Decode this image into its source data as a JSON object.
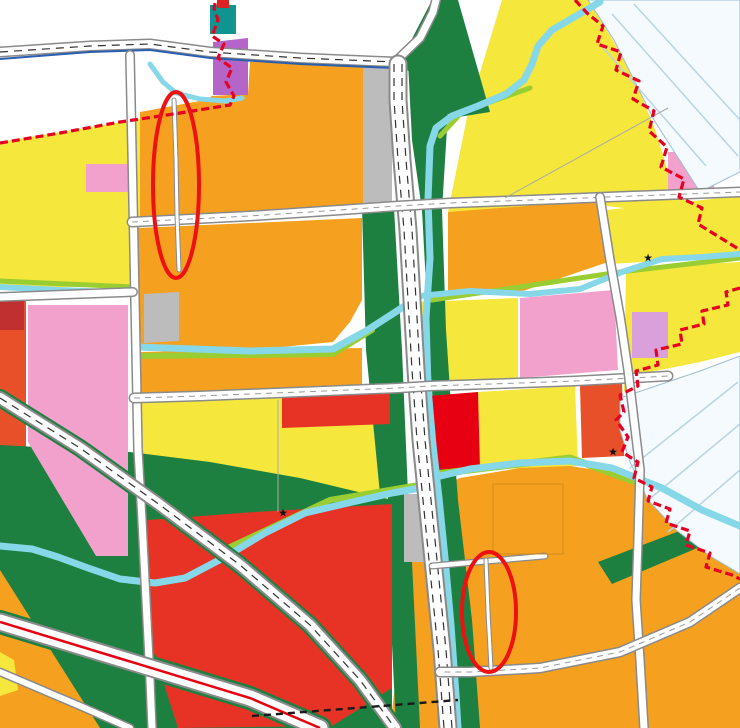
{
  "map": {
    "palette": {
      "yellow": "#F5E73B",
      "orange": "#F5A01E",
      "orange_red": "#E8502A",
      "red": "#E63326",
      "bright_red": "#E60012",
      "pink": "#F2A0CC",
      "violet": "#B565C8",
      "purple": "#7B3FA0",
      "gray": "#BCBCBC",
      "green": "#1E8040",
      "lime": "#9ACD32",
      "river": "#86D7E8",
      "teal": "#0F9490",
      "boundary_red": "#E60023",
      "annotation_red": "#EE1111"
    },
    "road_labels": [
      {
        "text": "青",
        "x": 56,
        "y": 45
      },
      {
        "text": "路",
        "x": 310,
        "y": 83
      },
      {
        "text": "路",
        "x": 406,
        "y": 25
      },
      {
        "text": "胜",
        "x": 218,
        "y": 225
      },
      {
        "text": "巷",
        "x": 343,
        "y": 211
      },
      {
        "text": "路",
        "x": 558,
        "y": 201
      },
      {
        "text": "海",
        "x": 414,
        "y": 167
      },
      {
        "text": "曹",
        "x": 131,
        "y": 153
      },
      {
        "text": "浦",
        "x": 135,
        "y": 379
      },
      {
        "text": "路",
        "x": 141,
        "y": 577
      },
      {
        "text": "路",
        "x": 83,
        "y": 301
      },
      {
        "text": "泗",
        "x": 201,
        "y": 395
      },
      {
        "text": "泾",
        "x": 428,
        "y": 387
      },
      {
        "text": "路",
        "x": 576,
        "y": 381
      },
      {
        "text": "曹",
        "x": 621,
        "y": 315
      },
      {
        "text": "新",
        "x": 638,
        "y": 541
      },
      {
        "text": "绕",
        "x": 401,
        "y": 463
      },
      {
        "text": "国",
        "x": 314,
        "y": 629
      },
      {
        "text": "高",
        "x": 152,
        "y": 693
      },
      {
        "text": "新",
        "x": 689,
        "y": 619
      }
    ],
    "river_labels": [
      {
        "text": "泾",
        "x": 29,
        "y": 141
      },
      {
        "text": "河",
        "x": 169,
        "y": 111
      },
      {
        "text": "沈",
        "x": 546,
        "y": 31
      },
      {
        "text": "巷",
        "x": 501,
        "y": 95
      },
      {
        "text": "新",
        "x": 444,
        "y": 126
      },
      {
        "text": "开",
        "x": 431,
        "y": 239
      },
      {
        "text": "河",
        "x": 424,
        "y": 335
      },
      {
        "text": "鞋",
        "x": 289,
        "y": 338
      },
      {
        "text": "城",
        "x": 499,
        "y": 294
      },
      {
        "text": "浜",
        "x": 667,
        "y": 250
      },
      {
        "text": "河",
        "x": 693,
        "y": 129
      },
      {
        "text": "河",
        "x": 723,
        "y": 429
      },
      {
        "text": "浜",
        "x": 49,
        "y": 285
      },
      {
        "text": "河",
        "x": 66,
        "y": 554
      },
      {
        "text": "泗",
        "x": 329,
        "y": 503
      },
      {
        "text": "泾",
        "x": 517,
        "y": 468
      }
    ],
    "parcel_codes": [
      {
        "text": "1503",
        "x": 222,
        "y": 20,
        "variant": "light"
      },
      {
        "text": "0901",
        "x": 222,
        "y": 84
      },
      {
        "text": "070102",
        "x": 509,
        "y": 25
      },
      {
        "text": "070102",
        "x": 579,
        "y": 98
      },
      {
        "text": "1401",
        "x": 533,
        "y": 70,
        "variant": "blue"
      },
      {
        "text": "070102",
        "x": 635,
        "y": 152
      },
      {
        "text": "080404",
        "x": 689,
        "y": 181
      },
      {
        "text": "0709",
        "x": 272,
        "y": 141
      },
      {
        "text": "120603",
        "x": 375,
        "y": 137
      },
      {
        "text": "0709",
        "x": 152,
        "y": 168
      },
      {
        "text": "080404",
        "x": 106,
        "y": 185
      },
      {
        "text": "0709",
        "x": 154,
        "y": 256
      },
      {
        "text": "0709",
        "x": 279,
        "y": 281
      },
      {
        "text": "0709",
        "x": 509,
        "y": 254
      },
      {
        "text": "070102",
        "x": 671,
        "y": 226
      },
      {
        "text": "0901",
        "x": 638,
        "y": 242
      },
      {
        "text": "070102",
        "x": 691,
        "y": 291
      },
      {
        "text": "0901",
        "x": 647,
        "y": 331
      },
      {
        "text": "080404",
        "x": 648,
        "y": 345
      },
      {
        "text": "080403",
        "x": 569,
        "y": 343
      },
      {
        "text": "080403",
        "x": 73,
        "y": 391
      },
      {
        "text": "080401",
        "x": 22,
        "y": 338
      },
      {
        "text": "0709",
        "x": 159,
        "y": 304
      },
      {
        "text": "120603",
        "x": 161,
        "y": 336
      },
      {
        "text": "0706",
        "x": 244,
        "y": 373
      },
      {
        "text": "070102",
        "x": 214,
        "y": 463
      },
      {
        "text": "070102",
        "x": 326,
        "y": 463
      },
      {
        "text": "0901",
        "x": 311,
        "y": 413
      },
      {
        "text": "0901",
        "x": 461,
        "y": 433
      },
      {
        "text": "070102",
        "x": 541,
        "y": 429
      },
      {
        "text": "0809+0901",
        "x": 599,
        "y": 423
      },
      {
        "text": "120603",
        "x": 426,
        "y": 536
      },
      {
        "text": "0901",
        "x": 204,
        "y": 581
      },
      {
        "text": "0901",
        "x": 326,
        "y": 564
      },
      {
        "text": "0902",
        "x": 229,
        "y": 654
      },
      {
        "text": "0809+0901",
        "x": 41,
        "y": 701
      },
      {
        "text": "0709",
        "x": 466,
        "y": 626
      },
      {
        "text": "0709",
        "x": 498,
        "y": 526
      },
      {
        "text": "0709",
        "x": 591,
        "y": 576
      },
      {
        "text": "0709",
        "x": 734,
        "y": 528
      },
      {
        "text": "0709",
        "x": 731,
        "y": 721
      }
    ],
    "icons": [
      {
        "type": "star",
        "x": 648,
        "y": 258
      },
      {
        "type": "star",
        "x": 613,
        "y": 452
      },
      {
        "type": "star",
        "x": 283,
        "y": 513
      },
      {
        "type": "field",
        "color": "#e060a8",
        "x": 78,
        "y": 371
      },
      {
        "type": "field",
        "color": "#e060a8",
        "x": 560,
        "y": 316
      },
      {
        "type": "field",
        "color": "#e060a8",
        "x": 95,
        "y": 170
      },
      {
        "type": "field",
        "color": "#e060a8",
        "x": 113,
        "y": 170
      },
      {
        "type": "field",
        "color": "#e060a8",
        "x": 47,
        "y": 687
      },
      {
        "type": "field",
        "color": "#cc2222",
        "x": 598,
        "y": 398
      },
      {
        "type": "field",
        "color": "#cc2222",
        "x": 600,
        "y": 440
      },
      {
        "type": "field",
        "color": "#cc2222",
        "x": 12,
        "y": 315
      },
      {
        "type": "field",
        "color": "#7b3fa0",
        "x": 700,
        "y": 160
      },
      {
        "type": "field",
        "color": "#7b3fa0",
        "x": 641,
        "y": 320
      },
      {
        "type": "mark",
        "x": 175,
        "y": 128
      },
      {
        "type": "mark",
        "x": 176,
        "y": 158
      },
      {
        "type": "mark",
        "x": 176,
        "y": 242
      },
      {
        "type": "mark",
        "x": 487,
        "y": 582
      },
      {
        "type": "mark",
        "x": 489,
        "y": 642
      }
    ],
    "annotations": {
      "ellipse_1": {
        "cx": 176,
        "cy": 185,
        "rx": 23,
        "ry": 93
      },
      "ellipse_2": {
        "cx": 489,
        "cy": 612,
        "rx": 27,
        "ry": 60
      }
    }
  }
}
